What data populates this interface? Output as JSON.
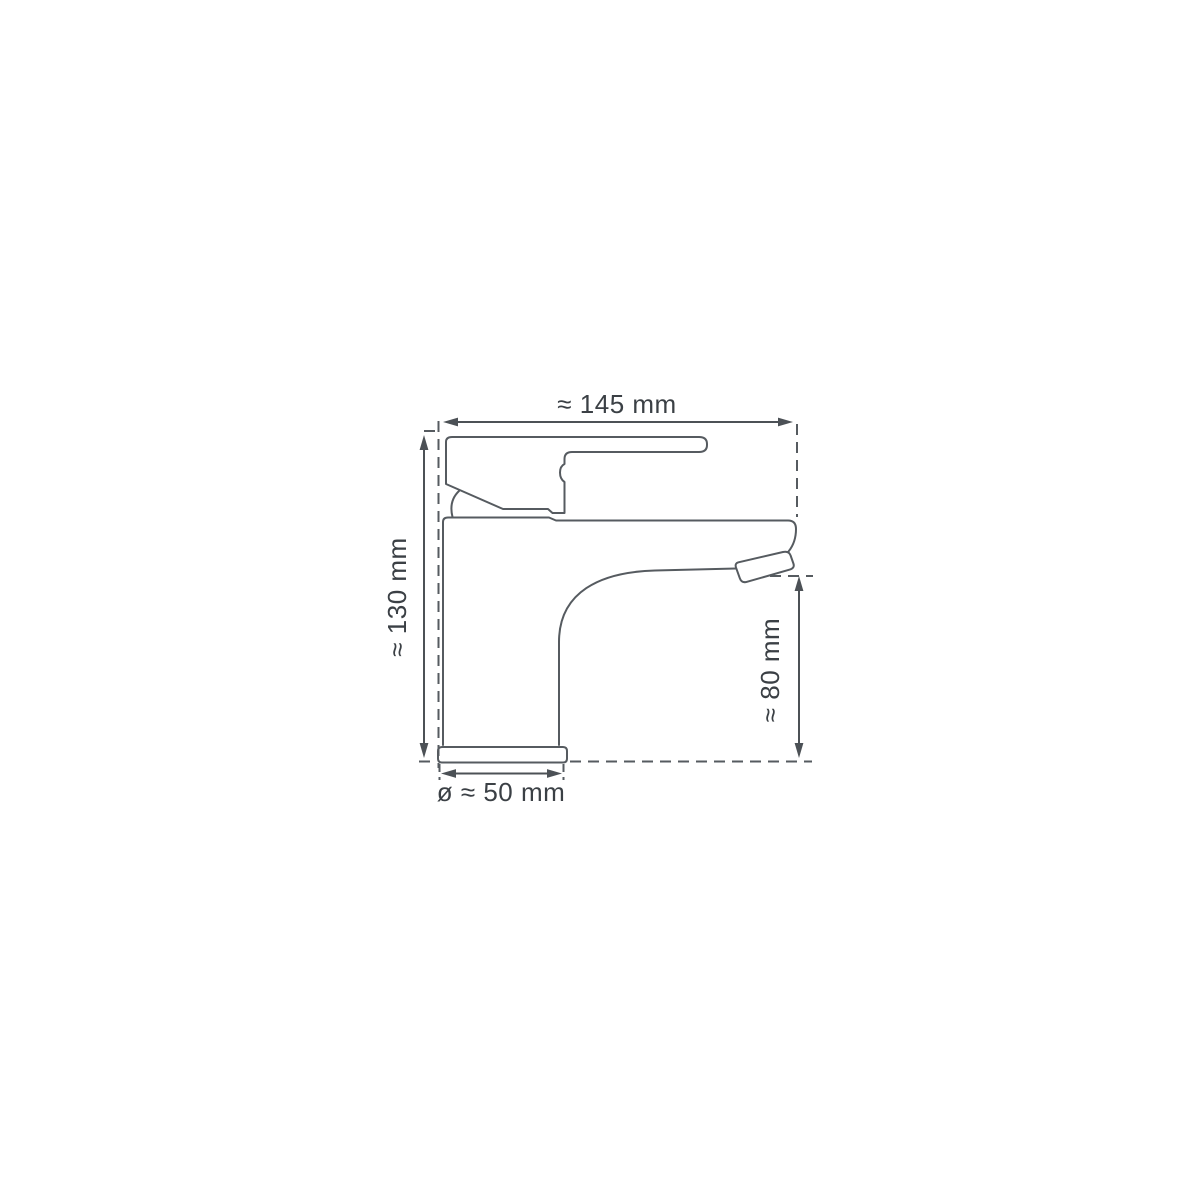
{
  "diagram": {
    "subject": "Single-lever basin mixer tap, side elevation technical drawing with dimensions",
    "labels": {
      "width": "≈ 145 mm",
      "height": "≈ 130 mm",
      "spout_height": "≈ 80 mm",
      "base_diameter": "ø ≈ 50 mm"
    },
    "colors": {
      "line": "#565b60",
      "dimension_line": "#4c5156",
      "text": "#3b4045",
      "background": "#ffffff"
    }
  }
}
